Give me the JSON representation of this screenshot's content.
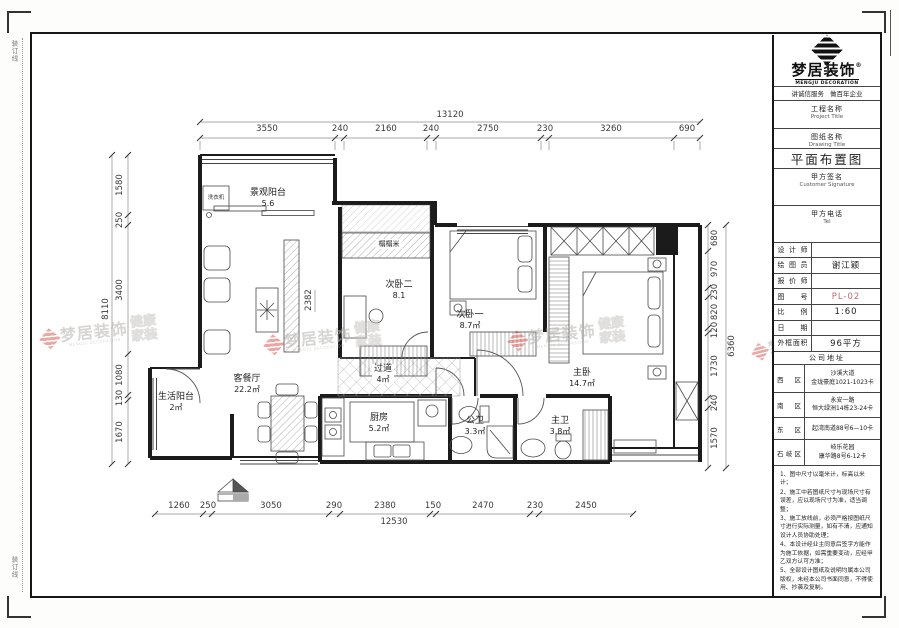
{
  "sheet": {
    "fold_label": "装订线"
  },
  "brand": {
    "name": "梦居装饰",
    "reg": "®",
    "subtitle": "MENGJU DECORATION",
    "slogan_left": "讲诚信服务",
    "slogan_right": "做百年企业"
  },
  "watermark": {
    "brand": "梦居装饰",
    "subtitle": "MENGJU DECORATION",
    "tag_line1": "健康",
    "tag_line2": "家装"
  },
  "title_block": {
    "project_label_cn": "工程名称",
    "project_label_en": "Project Title",
    "drawing_label_cn": "图纸名称",
    "drawing_label_en": "Drawing Title",
    "drawing_title": "平面布置图",
    "signature_label_cn": "甲方签名",
    "signature_label_en": "Customer Signature",
    "tel_label_cn": "甲方电话",
    "tel_label_en": "Tel",
    "rows": [
      {
        "label": "设计师",
        "value": ""
      },
      {
        "label": "绘图员",
        "value": "谢江颖"
      },
      {
        "label": "报价师",
        "value": ""
      },
      {
        "label": "图号",
        "value": "PL-02"
      },
      {
        "label": "比例",
        "value": "1:60"
      },
      {
        "label": "日期",
        "value": ""
      },
      {
        "label": "外框面积",
        "value": "96平方"
      }
    ],
    "address_header": "公司地址",
    "addresses": [
      {
        "label": "西区",
        "value": "沙溪大道\n金珑豪庭1021-1023卡"
      },
      {
        "label": "南区",
        "value": "永安一路\n恒大绿洲14栋23-24卡"
      },
      {
        "label": "东区",
        "value": "起湾南道88号6—10卡"
      },
      {
        "label": "石岐区",
        "value": "岐乐花园\n康华路8号6-12卡"
      }
    ],
    "notes": [
      "1、图中尺寸以毫米计，标高以米计；",
      "2、施工中若图纸尺寸与现场尺寸有误差，应以现场尺寸为准，适当调整；",
      "3、施工放线前，必须严格按图纸尺寸进行实际测量，如有不清，应通知设计人员协助处理；",
      "4、本设计经业主同意后签字方能作为施工依据，如需重要变动，应经甲乙双方认可方准；",
      "5、全部设计图纸及说明均属本公司版权，未经本公司书面同意，不得使用、抄袭及复制。"
    ]
  },
  "plan": {
    "rooms": {
      "balcony_view": {
        "name": "景观阳台",
        "area": "5.6"
      },
      "bedroom2": {
        "name": "次卧二",
        "area": "8.1"
      },
      "bedroom1": {
        "name": "次卧一",
        "area": "8.7㎡"
      },
      "master": {
        "name": "主卧",
        "area": "14.7㎡"
      },
      "living": {
        "name": "客餐厅",
        "area": "22.2㎡"
      },
      "hallway": {
        "name": "过道",
        "area": "4㎡"
      },
      "kitchen": {
        "name": "厨房",
        "area": "5.2㎡"
      },
      "bath_public": {
        "name": "公卫",
        "area": "3.3㎡"
      },
      "bath_master": {
        "name": "主卫",
        "area": "3.8㎡"
      },
      "balcony_life": {
        "name": "生活阳台",
        "area": "2㎡"
      }
    },
    "annotations": {
      "tatami": "榻榻米",
      "washer": "洗衣机"
    },
    "inner_dim": "2382",
    "dims": {
      "top": {
        "total": "13120",
        "segments": [
          "3550",
          "240",
          "2160",
          "240",
          "2750",
          "230",
          "3260",
          "690"
        ]
      },
      "bottom": {
        "total": "12530",
        "segments": [
          "1260",
          "250",
          "3050",
          "290",
          "2380",
          "150",
          "2470",
          "230",
          "2450"
        ]
      },
      "left": {
        "total": "8110",
        "segments": [
          "1580",
          "250",
          "3400",
          "1080",
          "130",
          "1670"
        ]
      },
      "right": {
        "total": "6360",
        "segments": [
          "680",
          "970",
          "230",
          "820",
          "120",
          "1730",
          "240",
          "1570"
        ]
      }
    }
  }
}
